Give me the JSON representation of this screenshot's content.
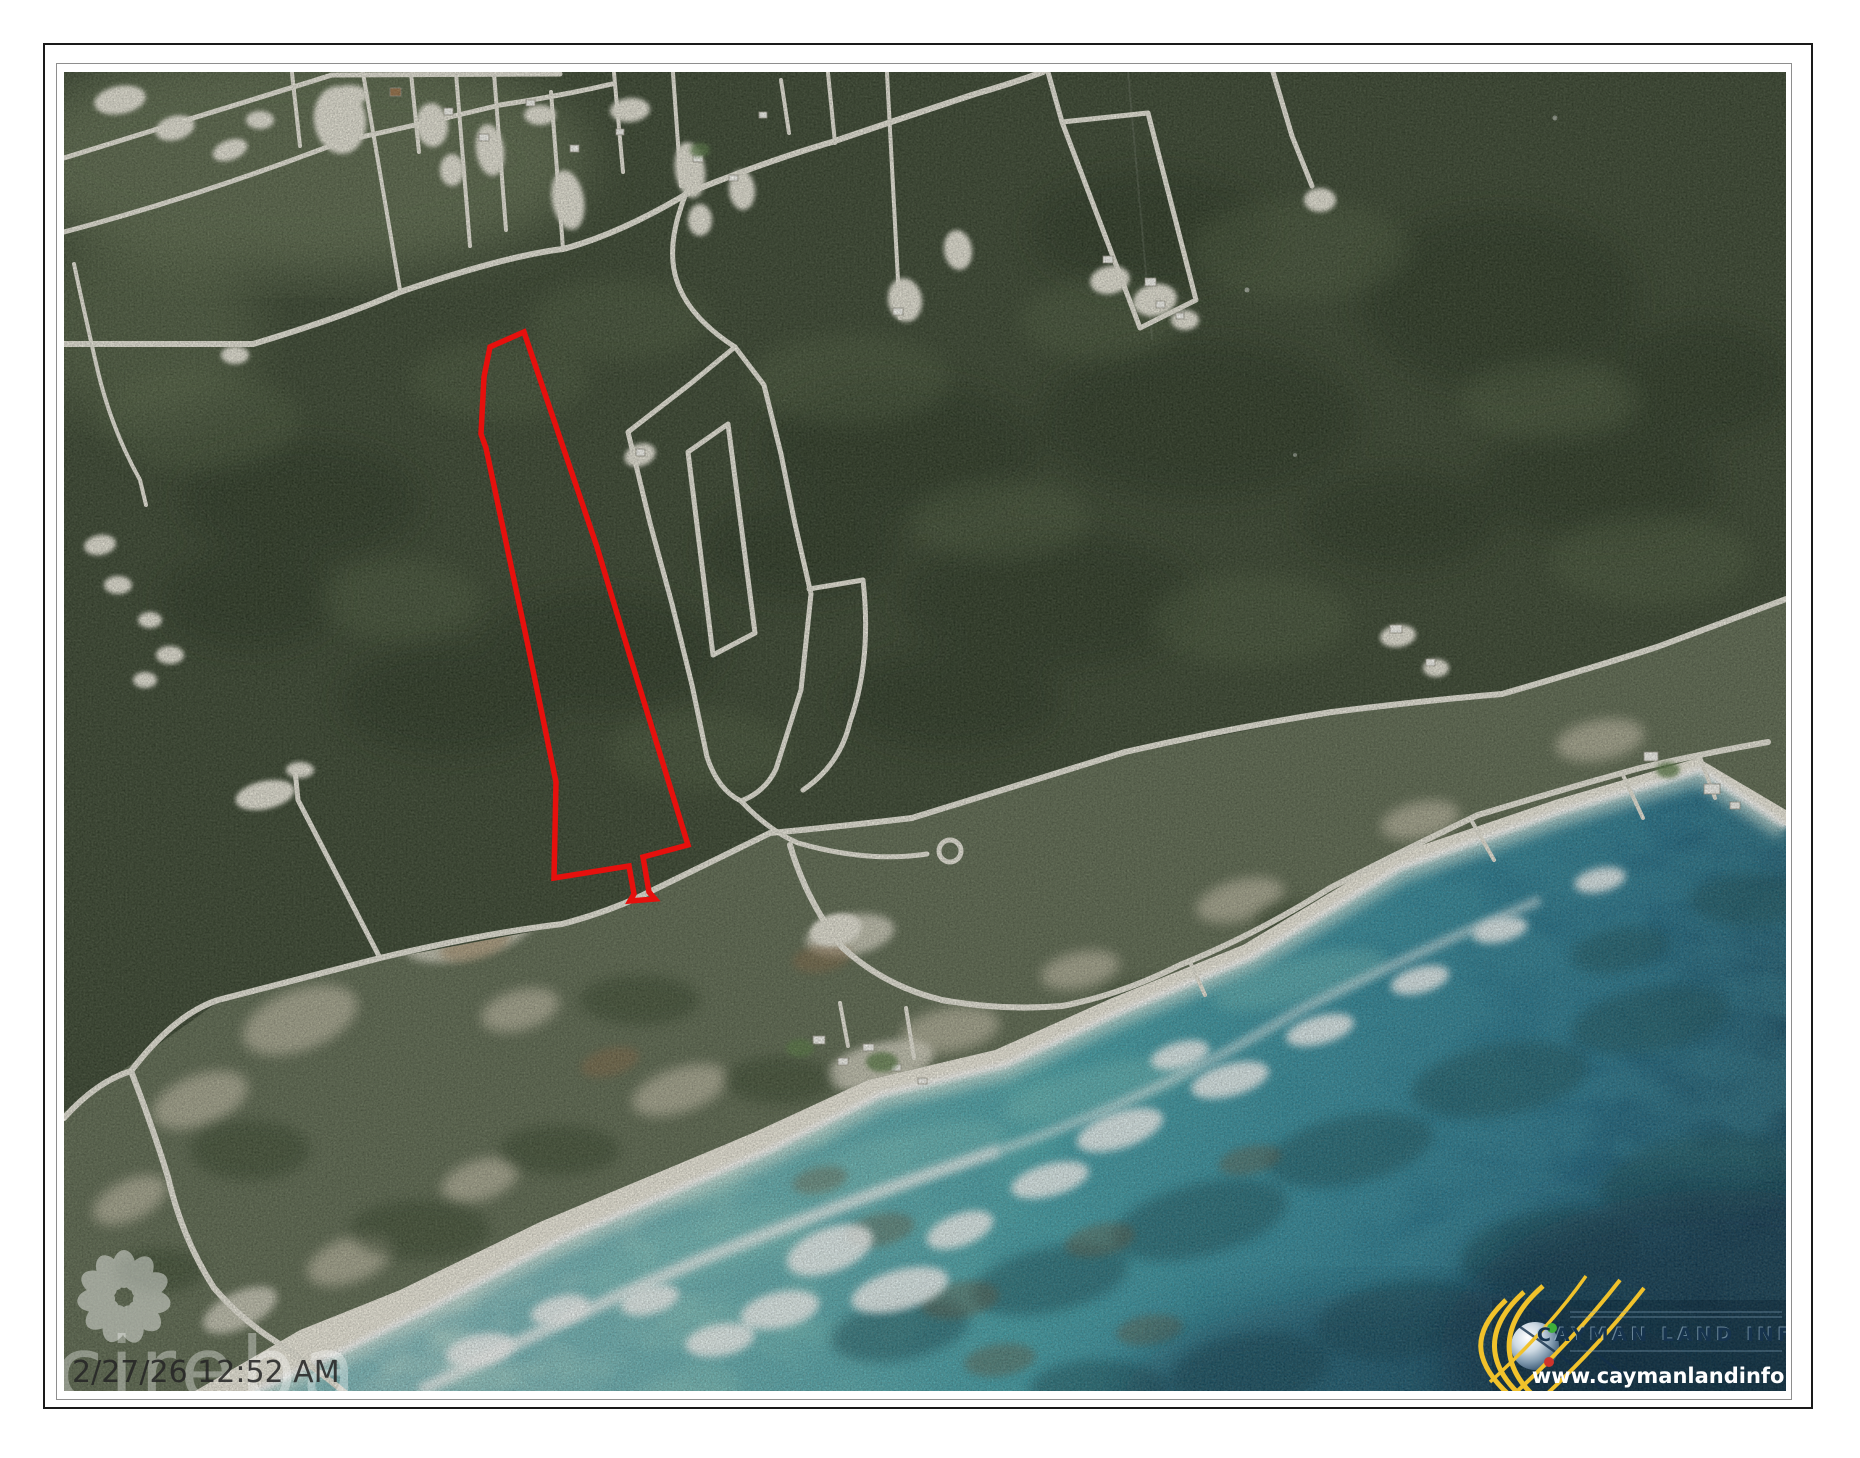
{
  "map_overlay": {
    "timestamp": "2/27/26 12:52 AM",
    "watermark_text": "cireba",
    "watermark_icon": "flower-petals-watermark-icon",
    "parcel_color": "#e6100d"
  },
  "branding": {
    "logo_icon": "cayman-land-info-globe-icon",
    "title": "CAYMAN LAND INFO",
    "website": "www.caymanlandinfo.ky",
    "gold": "#f1c22b",
    "dot_green": "#3fae3a",
    "dot_red": "#cf352c",
    "title_color": "#16334d",
    "website_color": "#ffffff"
  },
  "palette": {
    "page_background": "#ffffff",
    "outer_border": "#1a1a1a",
    "inner_border": "#8e8e8e",
    "forest_green": "#394530",
    "coastal_scrub": "#5f6a52",
    "beach_sand": "#f3efe3",
    "road": "#ece9de",
    "water_shallow": "#c2e4da",
    "water_mid": "#2a8399",
    "water_deep": "#0b3048"
  }
}
